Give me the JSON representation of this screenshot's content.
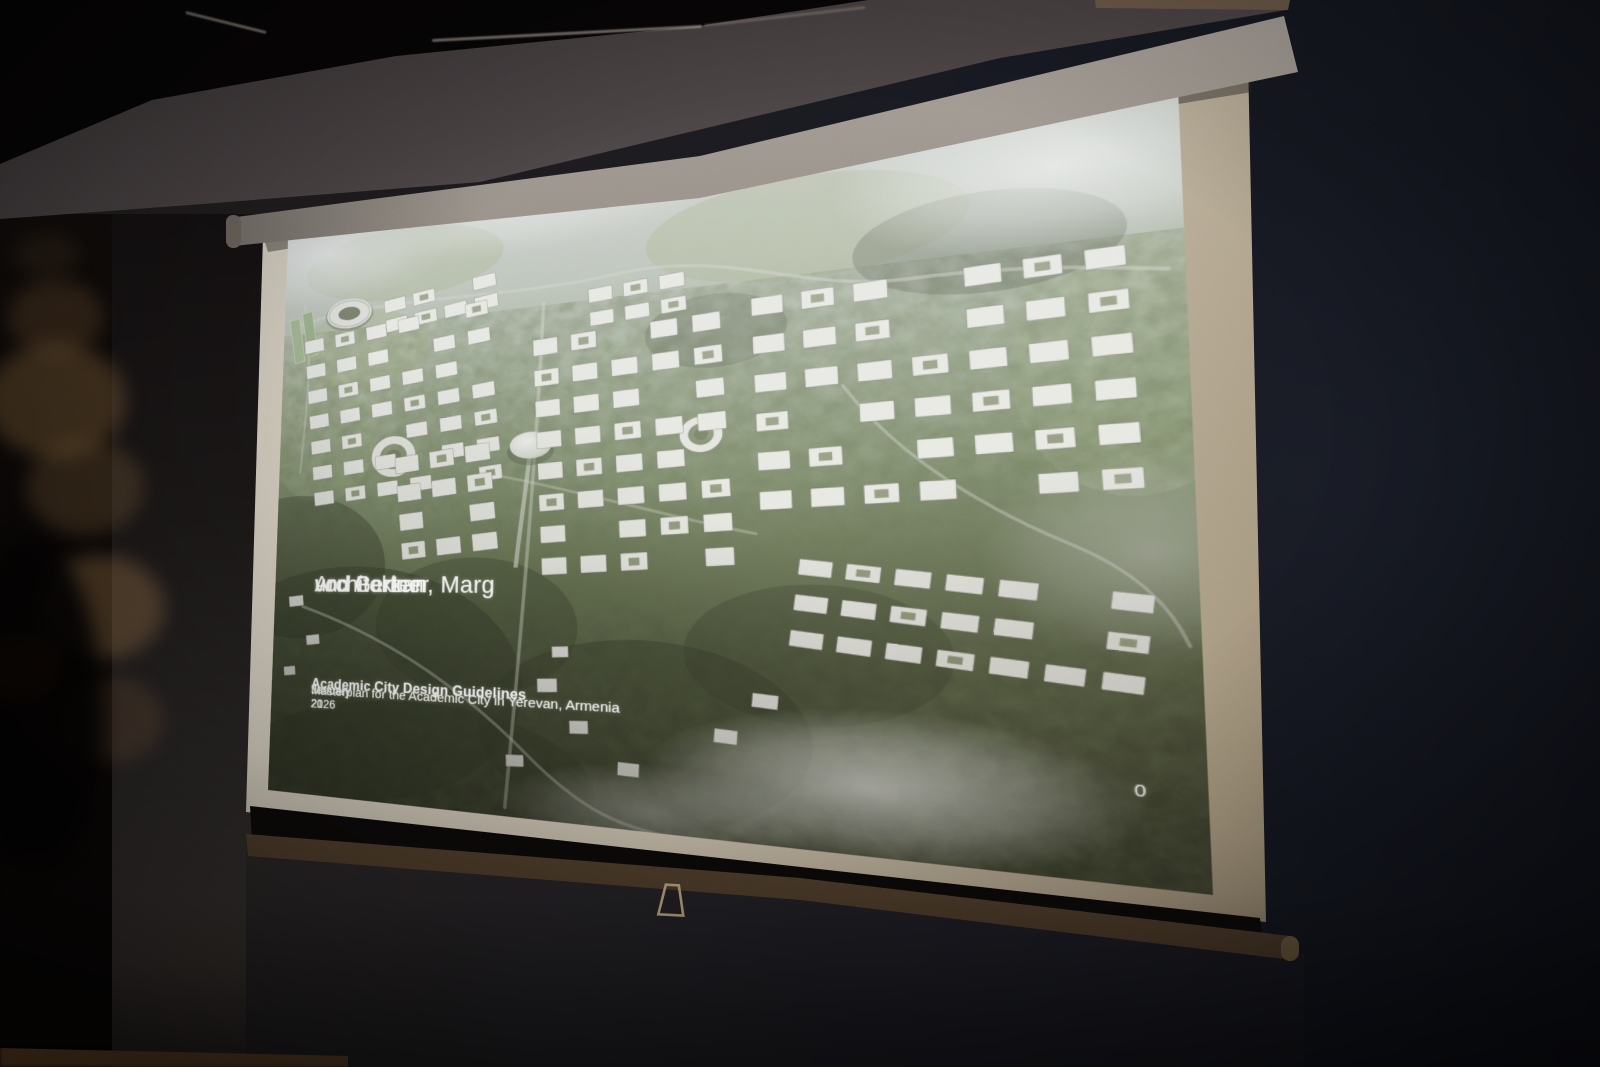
{
  "slide": {
    "author_block": {
      "lines": [
        "Architekten",
        "von Gerkan, Marg",
        "und Partner"
      ]
    },
    "title": "Academic City Design Guidelines",
    "subtitle": "Masterplan for the Academic City in Yerevan, Armenia",
    "date": {
      "prefix": "January 21",
      "superscript": "st",
      "suffix": ". 2026"
    },
    "page_number": "0",
    "artwork": {
      "type": "aerial-rendering-masterplan",
      "landmarks": [
        "stadium",
        "sports-fields",
        "ring-building-left",
        "central-dome",
        "ring-building-right",
        "central-axis-bridge"
      ],
      "palette": {
        "building": "#ecece5",
        "building_stroke": "rgba(72,78,58,0.45)",
        "courtyard": "#7d8a5e",
        "road": "#cfd3c3",
        "meadow": "#9fae7d",
        "forest": "#2e3820"
      },
      "meadows": [
        {
          "cx": 600,
          "cy": 80,
          "rx": 150,
          "ry": 55,
          "o": 0.5
        },
        {
          "cx": 160,
          "cy": 55,
          "rx": 130,
          "ry": 45,
          "o": 0.45
        },
        {
          "cx": 108,
          "cy": 160,
          "rx": 90,
          "ry": 52,
          "o": 0.5
        },
        {
          "cx": 870,
          "cy": 250,
          "rx": 90,
          "ry": 120,
          "o": 0.35
        },
        {
          "cx": 60,
          "cy": 250,
          "rx": 80,
          "ry": 100,
          "o": 0.3
        }
      ],
      "forest_patches": [
        {
          "cx": 110,
          "cy": 570,
          "rx": 210,
          "ry": 140,
          "o": 0.5
        },
        {
          "cx": 30,
          "cy": 430,
          "rx": 120,
          "ry": 90,
          "o": 0.45
        },
        {
          "cx": 260,
          "cy": 500,
          "rx": 120,
          "ry": 80,
          "o": 0.35
        },
        {
          "cx": 440,
          "cy": 610,
          "rx": 170,
          "ry": 100,
          "o": 0.42
        },
        {
          "cx": 610,
          "cy": 520,
          "rx": 120,
          "ry": 70,
          "o": 0.3
        },
        {
          "cx": 180,
          "cy": 680,
          "rx": 220,
          "ry": 90,
          "o": 0.5
        },
        {
          "cx": 520,
          "cy": 180,
          "rx": 70,
          "ry": 40,
          "o": 0.25
        },
        {
          "cx": 760,
          "cy": 120,
          "rx": 110,
          "ry": 50,
          "o": 0.3
        }
      ],
      "roads": [
        {
          "d": "M 18,118 C 140,92 300,118 420,104 C 540,92 600,150 700,148 C 790,146 850,158 898,166",
          "w": 3.5,
          "o": 0.5
        },
        {
          "d": "M 338,128 C 332,300 320,480 302,700",
          "w": 4,
          "o": 0.5
        },
        {
          "d": "M 40,480 C 170,520 260,580 330,644 C 400,706 440,706 470,712",
          "w": 3.5,
          "o": 0.45
        },
        {
          "d": "M 640,250 C 690,330 760,380 824,414 C 872,440 892,472 902,502",
          "w": 3,
          "o": 0.45
        },
        {
          "d": "M 28,92 C 44,150 36,230 30,310",
          "w": 3,
          "o": 0.4
        },
        {
          "d": "M 290,326 C 400,352 480,380 560,398",
          "w": 3,
          "o": 0.4
        }
      ],
      "clusters": [
        {
          "x": 139,
          "y": 100,
          "cols": 4,
          "rows": 2,
          "w": 28,
          "h": 16,
          "gx": 10,
          "gy": 9,
          "rot": -7,
          "skip": [
            2
          ]
        },
        {
          "x": 30,
          "y": 140,
          "cols": 6,
          "rows": 7,
          "w": 27,
          "h": 17,
          "gx": 16,
          "gy": 16,
          "rot": -6,
          "skip": [
            4,
            9,
            17,
            26,
            33,
            40
          ]
        },
        {
          "x": 159,
          "y": 298,
          "cols": 3,
          "rows": 4,
          "w": 30,
          "h": 20,
          "gx": 14,
          "gy": 15,
          "rot": -6,
          "skip": [
            7
          ]
        },
        {
          "x": 326,
          "y": 170,
          "cols": 5,
          "rows": 8,
          "w": 28,
          "h": 19,
          "gx": 15,
          "gy": 17,
          "rot": -3,
          "skip": [
            2,
            13,
            24,
            31,
            38
          ]
        },
        {
          "x": 388,
          "y": 118,
          "cols": 3,
          "rows": 2,
          "w": 26,
          "h": 16,
          "gx": 12,
          "gy": 11,
          "rot": -4,
          "skip": []
        },
        {
          "x": 556,
          "y": 150,
          "cols": 7,
          "rows": 6,
          "w": 30,
          "h": 19,
          "gx": 17,
          "gy": 22,
          "rot": -2,
          "skip": [
            3,
            10,
            22,
            30,
            39
          ]
        },
        {
          "x": 600,
          "y": 424,
          "cols": 7,
          "rows": 3,
          "w": 30,
          "h": 16,
          "gx": 12,
          "gy": 20,
          "rot": 7,
          "skip": [
            5,
            12
          ]
        }
      ],
      "single_buildings": [
        {
          "x": 20,
          "y": 468,
          "w": 20,
          "h": 13,
          "rot": -7
        },
        {
          "x": 46,
          "y": 516,
          "w": 18,
          "h": 12,
          "rot": -7
        },
        {
          "x": 16,
          "y": 556,
          "w": 16,
          "h": 11,
          "rot": -7
        },
        {
          "x": 336,
          "y": 556,
          "w": 22,
          "h": 15,
          "rot": -3
        },
        {
          "x": 372,
          "y": 600,
          "w": 20,
          "h": 14,
          "rot": -3
        },
        {
          "x": 302,
          "y": 642,
          "w": 20,
          "h": 13,
          "rot": -3
        },
        {
          "x": 424,
          "y": 640,
          "w": 22,
          "h": 14,
          "rot": 2
        },
        {
          "x": 352,
          "y": 520,
          "w": 18,
          "h": 12,
          "rot": -3
        },
        {
          "x": 520,
          "y": 598,
          "w": 22,
          "h": 14,
          "rot": 4
        },
        {
          "x": 556,
          "y": 560,
          "w": 24,
          "h": 14,
          "rot": 5
        }
      ],
      "fog": [
        {
          "cx": 60,
          "cy": 30,
          "rx": 170,
          "ry": 70,
          "o": 0.85
        },
        {
          "cx": 320,
          "cy": 10,
          "rx": 220,
          "ry": 55,
          "o": 0.6
        },
        {
          "cx": 820,
          "cy": 55,
          "rx": 190,
          "ry": 85,
          "o": 0.9
        },
        {
          "cx": 660,
          "cy": 645,
          "rx": 210,
          "ry": 75,
          "o": 0.85
        },
        {
          "cx": 880,
          "cy": 420,
          "rx": 130,
          "ry": 100,
          "o": 0.4
        },
        {
          "cx": 460,
          "cy": 690,
          "rx": 160,
          "ry": 50,
          "o": 0.5
        }
      ]
    }
  },
  "colors": {
    "slide_text": "#f4f4f0",
    "screen_surface": "#d3ccbd",
    "screen_housing": "#8f8880",
    "bottom_bar": "#7c6448",
    "wall_navy": "#141720",
    "ceiling": "#4b4344"
  }
}
